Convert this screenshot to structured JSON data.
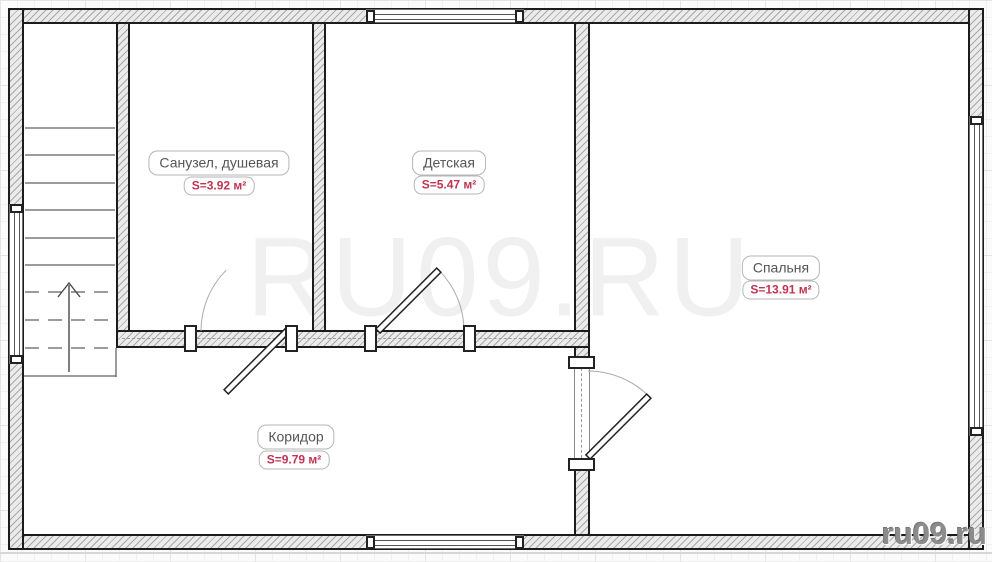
{
  "watermark": {
    "text": "RU09.RU"
  },
  "branding": {
    "site": "ru09.ru"
  },
  "rooms": [
    {
      "id": "bathroom",
      "name": "Санузел, душевая",
      "area": "S=3.92 м²"
    },
    {
      "id": "children",
      "name": "Детская",
      "area": "S=5.47 м²"
    },
    {
      "id": "bedroom",
      "name": "Спальня",
      "area": "S=13.91 м²"
    },
    {
      "id": "corridor",
      "name": "Коридор",
      "area": "S=9.79 м²"
    }
  ],
  "colors": {
    "area_label": "#c03352",
    "room_label": "#555555",
    "wall_hatch": "#a8a8a8",
    "watermark": "#f0f0f0"
  }
}
